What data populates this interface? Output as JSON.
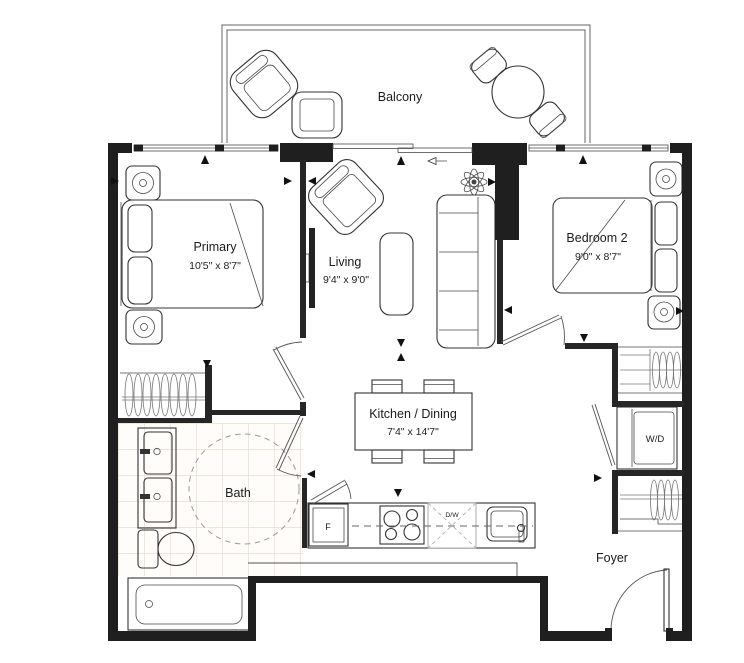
{
  "page": {
    "background": "#ffffff"
  },
  "floor_plan": {
    "rooms": {
      "balcony": {
        "name": "Balcony"
      },
      "primary": {
        "name": "Primary",
        "dimensions": "10'5\" x 8'7\""
      },
      "living": {
        "name": "Living",
        "dimensions": "9'4\" x 9'0\""
      },
      "bedroom2": {
        "name": "Bedroom 2",
        "dimensions": "9'0\" x 8'7\""
      },
      "kitchen_dining": {
        "name": "Kitchen / Dining",
        "dimensions": "7'4\" x 14'7\""
      },
      "bath": {
        "name": "Bath"
      },
      "foyer": {
        "name": "Foyer"
      }
    },
    "fixtures": {
      "washer_dryer": "W/D",
      "fridge": "F",
      "dishwasher": "D/W"
    },
    "colors": {
      "walls": "#1f1f1f",
      "furniture_lines": "#3a3a3a",
      "bath_tile_line": "#e6dfcf",
      "background": "#ffffff"
    }
  }
}
